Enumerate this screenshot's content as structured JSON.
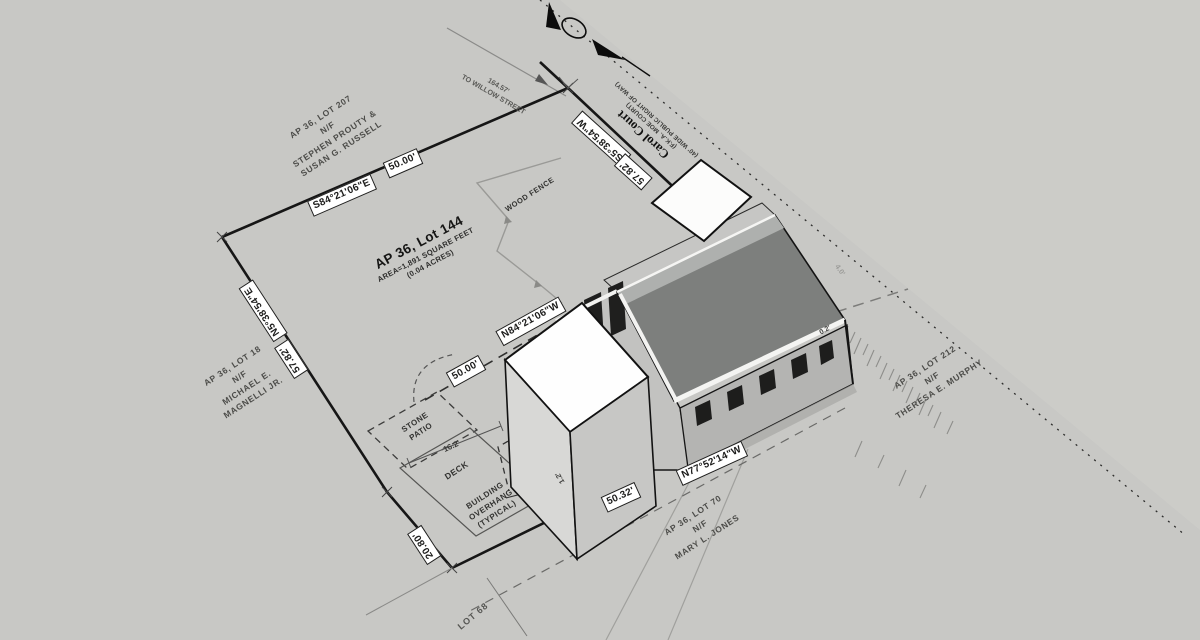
{
  "view": {
    "tool": "orbit-viewport"
  },
  "parcel": {
    "title": "AP 36, Lot 144",
    "area_line1": "AREA=1,891 SQUARE FEET",
    "area_line2": "(0.04 ACRES)"
  },
  "boundary": {
    "north": {
      "bearing": "S84°21'06\"E",
      "distance": "50.00'"
    },
    "east": {
      "bearing": "S5°38'54\"W",
      "distance": "57.82'"
    },
    "west": {
      "bearing": "N5°38'54\"E",
      "distance": "57.82'"
    },
    "south": {
      "bearing": "N77°52'14\"W",
      "distance": "50.32'"
    },
    "rear": {
      "bearing": "N84°21'06\"W",
      "distance": "50.00'"
    },
    "west_jog": {
      "distance": "20.80'"
    }
  },
  "abutters": {
    "north": {
      "lines": [
        "AP 36, LOT 207",
        "N/F",
        "STEPHEN PROUTY &",
        "SUSAN G. RUSSELL"
      ]
    },
    "west": {
      "lines": [
        "AP 36, LOT 18",
        "N/F",
        "MICHAEL E.",
        "MAGNELLI JR."
      ]
    },
    "south": {
      "lines": [
        "AP 36, LOT 70",
        "N/F",
        "MARY L. JONES"
      ]
    },
    "east": {
      "lines": [
        "AP 36, LOT 212",
        "N/F",
        "THERESA E. MURPHY"
      ]
    },
    "bottom": {
      "lines": [
        "LOT 68"
      ]
    }
  },
  "street": {
    "name": "Carol Court",
    "aka": "(F.K.A. MOE COURT)",
    "right_of_way": "(40' WIDE PUBLIC RIGHT OF WAY)",
    "to_distance": "164.57'",
    "to_label": "TO WILLOW STREET"
  },
  "site_notes": {
    "wood_fence": "WOOD FENCE",
    "stone_patio_l1": "STONE",
    "stone_patio_l2": "PATIO",
    "deck": "DECK",
    "overhang_l1": "BUILDING",
    "overhang_l2": "OVERHANG",
    "overhang_l3": "(TYPICAL)",
    "dim_deck": "16.2'",
    "dim_side": "1.2'",
    "dim_corner": "0.2'",
    "dim_road": "4.0'"
  },
  "colors": {
    "background": "#c8c8c5",
    "boundary_line": "#161616",
    "roof_dark": "#7d7f7d",
    "wall_gray": "#c2c2c0",
    "house_white": "#fefefe",
    "window_dark": "#1d1d1c"
  }
}
